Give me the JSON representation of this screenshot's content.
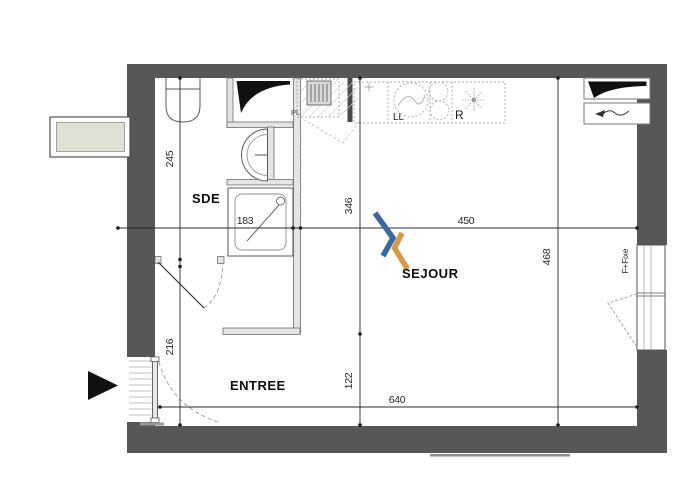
{
  "plan": {
    "rooms": {
      "sde": "SDE",
      "entree": "ENTREE",
      "sejour": "SEJOUR"
    },
    "annotations": {
      "closet": "PL",
      "washing_machine": "LL",
      "fridge": "R",
      "window": "F+Fixe"
    },
    "dimensions_cm": {
      "sde_depth": "245",
      "sde_width": "183",
      "entree_depth": "216",
      "sejour_upper": "346",
      "sejour_lower": "122",
      "sejour_width": "450",
      "interior_depth": "468",
      "interior_width": "640"
    },
    "colors": {
      "wall": "#575757",
      "logo_blue": "#39679e",
      "logo_orange": "#d39a43",
      "planter": "#e0e1d2",
      "ink_black": "#111111"
    }
  }
}
